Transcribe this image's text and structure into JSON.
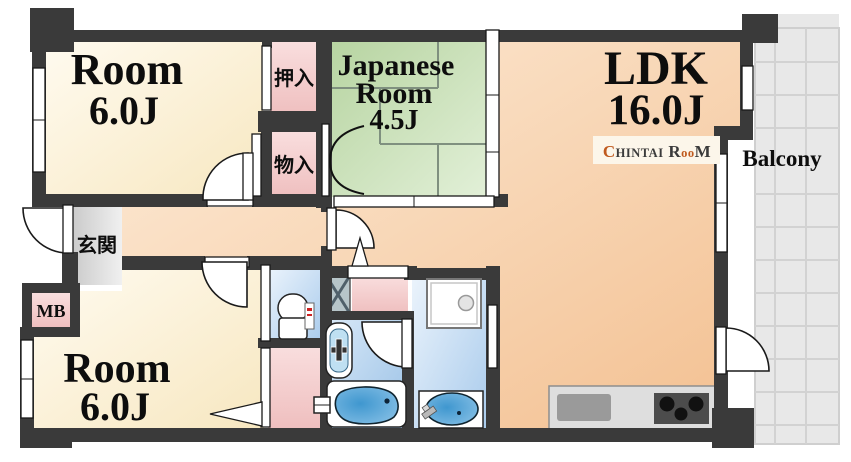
{
  "rooms": {
    "room_top": {
      "name": "Room",
      "size": "6.0J"
    },
    "room_bottom": {
      "name": "Room",
      "size": "6.0J"
    },
    "japanese_room": {
      "name_line1": "Japanese",
      "name_line2": "Room",
      "size": "4.5J"
    },
    "ldk": {
      "name": "LDK",
      "size": "16.0J"
    },
    "balcony": "Balcony",
    "genkan": "玄関",
    "oshiire": "押入",
    "monoire": "物入",
    "mb": "MB"
  },
  "logo": {
    "c": "C",
    "hintai": "HINTAI",
    "r": " R",
    "oo": "oo",
    "m": "M"
  },
  "colors": {
    "wall": "#3a3a3a",
    "cream_room": "#faeecf",
    "tatami_green": "#c3dcae",
    "closet_pink": "#f4cbcb",
    "ldk_peach": "#f6c89c",
    "water_blue": "#bad4ef",
    "bath_blue": "#a9c9e9",
    "genkan_gray": "#d9d9d9",
    "balcony_gray": "#e8e8e8",
    "tub_blue": "#4f9fd4",
    "logo_orange": "#c05a1e",
    "logo_gray": "#3b3b3b"
  }
}
